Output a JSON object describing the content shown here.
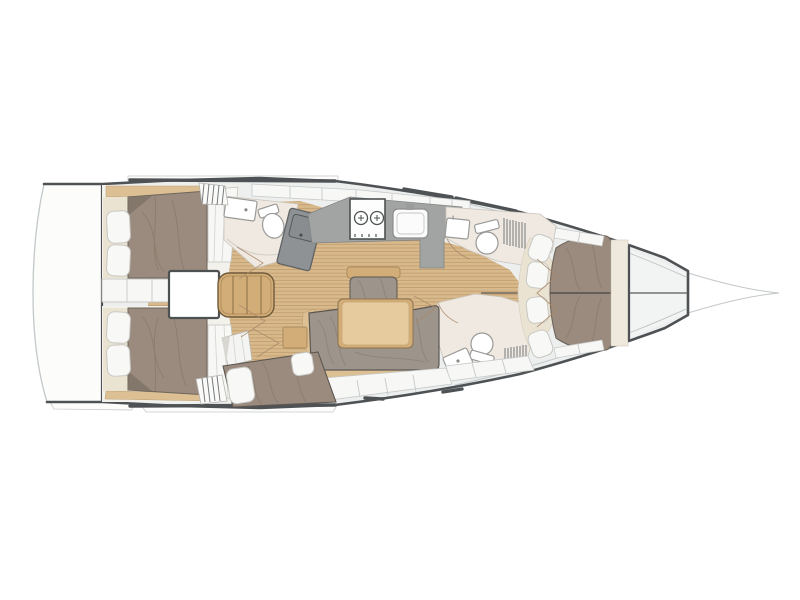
{
  "figure": {
    "subject": "sailing-yacht-interior-layout-plan",
    "view": "top-down-deck-plan",
    "orientation": "bow-right-stern-left",
    "visible_text_items": []
  },
  "features": {
    "double_berths": 4,
    "toilets": 3,
    "sinks_bath": 3,
    "galley_burners": 2,
    "galley_sinks": 1,
    "salon_tables": 1,
    "settees": 2,
    "shower_grates": 2,
    "stair_flights": 2,
    "pillows_aft": 4,
    "forward_seat_cushions": 4
  },
  "colors": {
    "background": "#ffffff",
    "hull_fill": "#edefef",
    "deck_white": "#fcfcfb",
    "outline_dark": "#4f5254",
    "outline_light": "#c3c8c8",
    "wood_base": "#d8b98c",
    "wood_stripe": "#c09a6b",
    "trim_tan": "#dcc094",
    "furniture_tan": "#d2ad77",
    "table_top": "#e6cb9f",
    "upholstery_bed": "#9a8b7e",
    "upholstery_sofa": "#9d948c",
    "cushion_white": "#f8f8f6",
    "cream": "#ebe3d2",
    "room_floor": "#f3f1ec",
    "bath_floor": "#efe9e1",
    "counter_gray": "#a2a4a3",
    "cabinet_gray": "#8f9294",
    "locker_white": "#f7f7f6",
    "headboard_cream": "#efe9dd"
  }
}
